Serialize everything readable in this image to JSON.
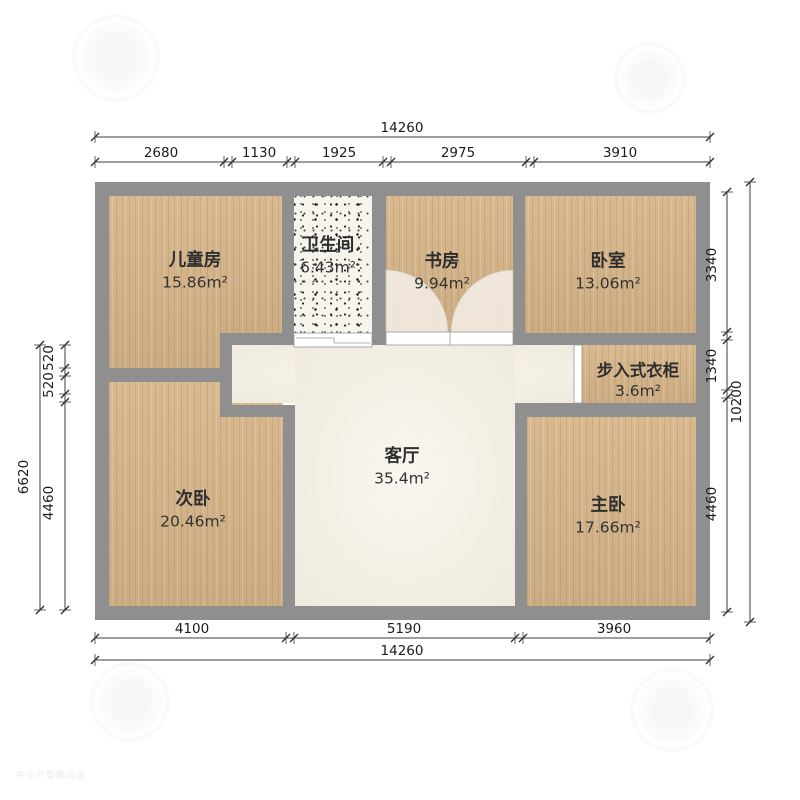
{
  "rooms": [
    {
      "name": "儿童房",
      "area": "15.86m²"
    },
    {
      "name": "卫生间",
      "area": "6.43m²"
    },
    {
      "name": "书房",
      "area": "9.94m²"
    },
    {
      "name": "卧室",
      "area": "13.06m²"
    },
    {
      "name": "步入式衣柜",
      "area": "3.6m²"
    },
    {
      "name": "次卧",
      "area": "20.46m²"
    },
    {
      "name": "客厅",
      "area": "35.4m²"
    },
    {
      "name": "主卧",
      "area": "17.66m²"
    }
  ],
  "dimensions": {
    "top": {
      "total": "14260",
      "segments": [
        "2680",
        "1130",
        "1925",
        "2975",
        "3910"
      ]
    },
    "bottom": {
      "total": "14260",
      "segments": [
        "4100",
        "5190",
        "3960"
      ]
    },
    "left": {
      "total": "6620",
      "segments": [
        "520",
        "520",
        "4460"
      ]
    },
    "right": {
      "total": "10200",
      "segments": [
        "3340",
        "1340",
        "4460"
      ]
    }
  },
  "watermark": {
    "corner_text": "中小户型图出品"
  },
  "colors": {
    "wall": "#8f8f8f",
    "wood_floor": "#d7b68a",
    "living_floor": "#f4efe2",
    "bathroom_floor": "#f7f4ec",
    "dimension_text": "#1c1c1c"
  }
}
